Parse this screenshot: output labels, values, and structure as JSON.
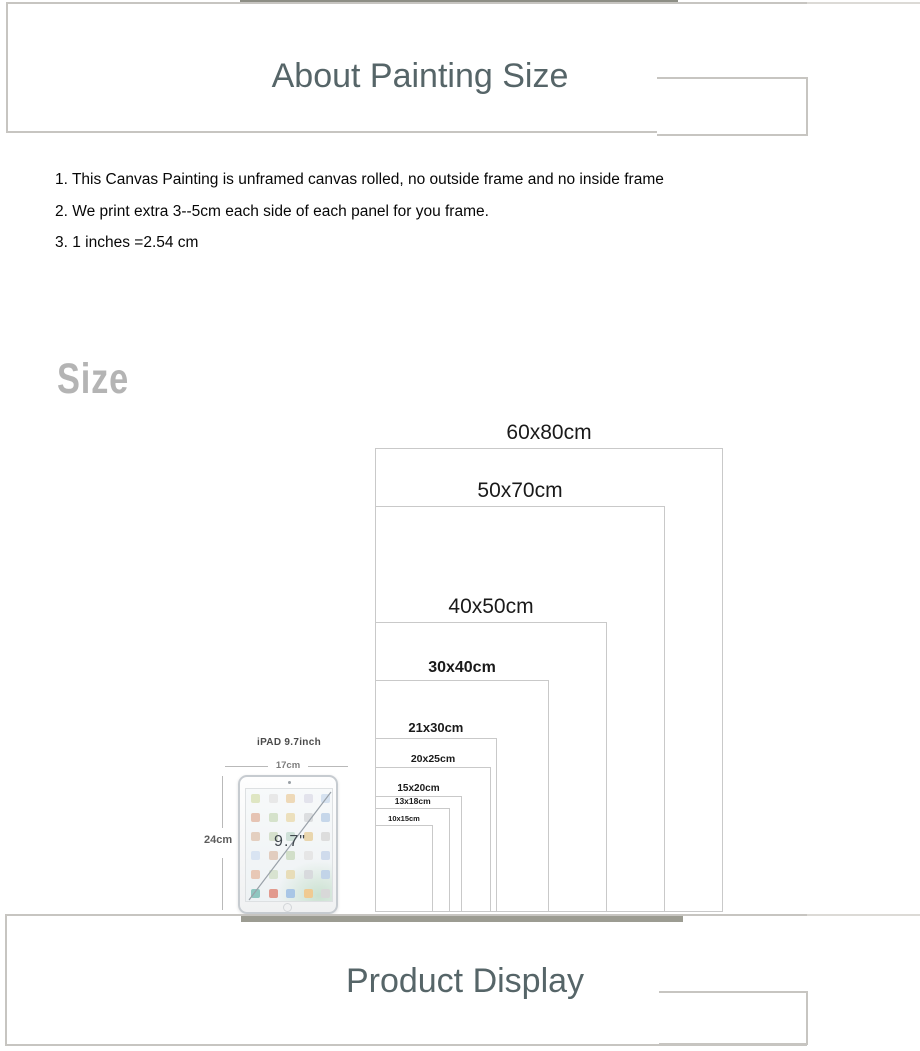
{
  "header_box": {
    "title": "About Painting Size"
  },
  "notes": {
    "items": [
      "1. This Canvas Painting is unframed canvas rolled, no outside frame and no inside frame",
      "2. We print extra 3--5cm each side of each panel for you frame.",
      "3. 1 inches =2.54 cm"
    ]
  },
  "size_section": {
    "heading": "Size"
  },
  "chart_data": {
    "type": "nested-size-comparison",
    "title": "Canvas size comparison, rectangles share a common bottom-left corner",
    "unit": "cm",
    "sizes": [
      {
        "label": "60x80cm",
        "width_cm": 60,
        "height_cm": 80
      },
      {
        "label": "50x70cm",
        "width_cm": 50,
        "height_cm": 70
      },
      {
        "label": "40x50cm",
        "width_cm": 40,
        "height_cm": 50
      },
      {
        "label": "30x40cm",
        "width_cm": 30,
        "height_cm": 40
      },
      {
        "label": "21x30cm",
        "width_cm": 21,
        "height_cm": 30
      },
      {
        "label": "20x25cm",
        "width_cm": 20,
        "height_cm": 25
      },
      {
        "label": "15x20cm",
        "width_cm": 15,
        "height_cm": 20
      },
      {
        "label": "13x18cm",
        "width_cm": 13,
        "height_cm": 18
      },
      {
        "label": "10x15cm",
        "width_cm": 10,
        "height_cm": 15
      }
    ],
    "reference_object": {
      "name": "iPAD 9.7inch",
      "width_label": "17cm",
      "height_label": "24cm",
      "screen_label": "9.7\""
    }
  },
  "footer_box": {
    "title": "Product Display"
  },
  "colors": {
    "title_color": "#566568",
    "watermark_color": "#b4b4b4",
    "box_border_color": "#c7c5c1",
    "rect_border_color": "#c9c9c9",
    "top_bar_color": "#8d8e85",
    "bottom_bar_color": "#9c9c92"
  }
}
